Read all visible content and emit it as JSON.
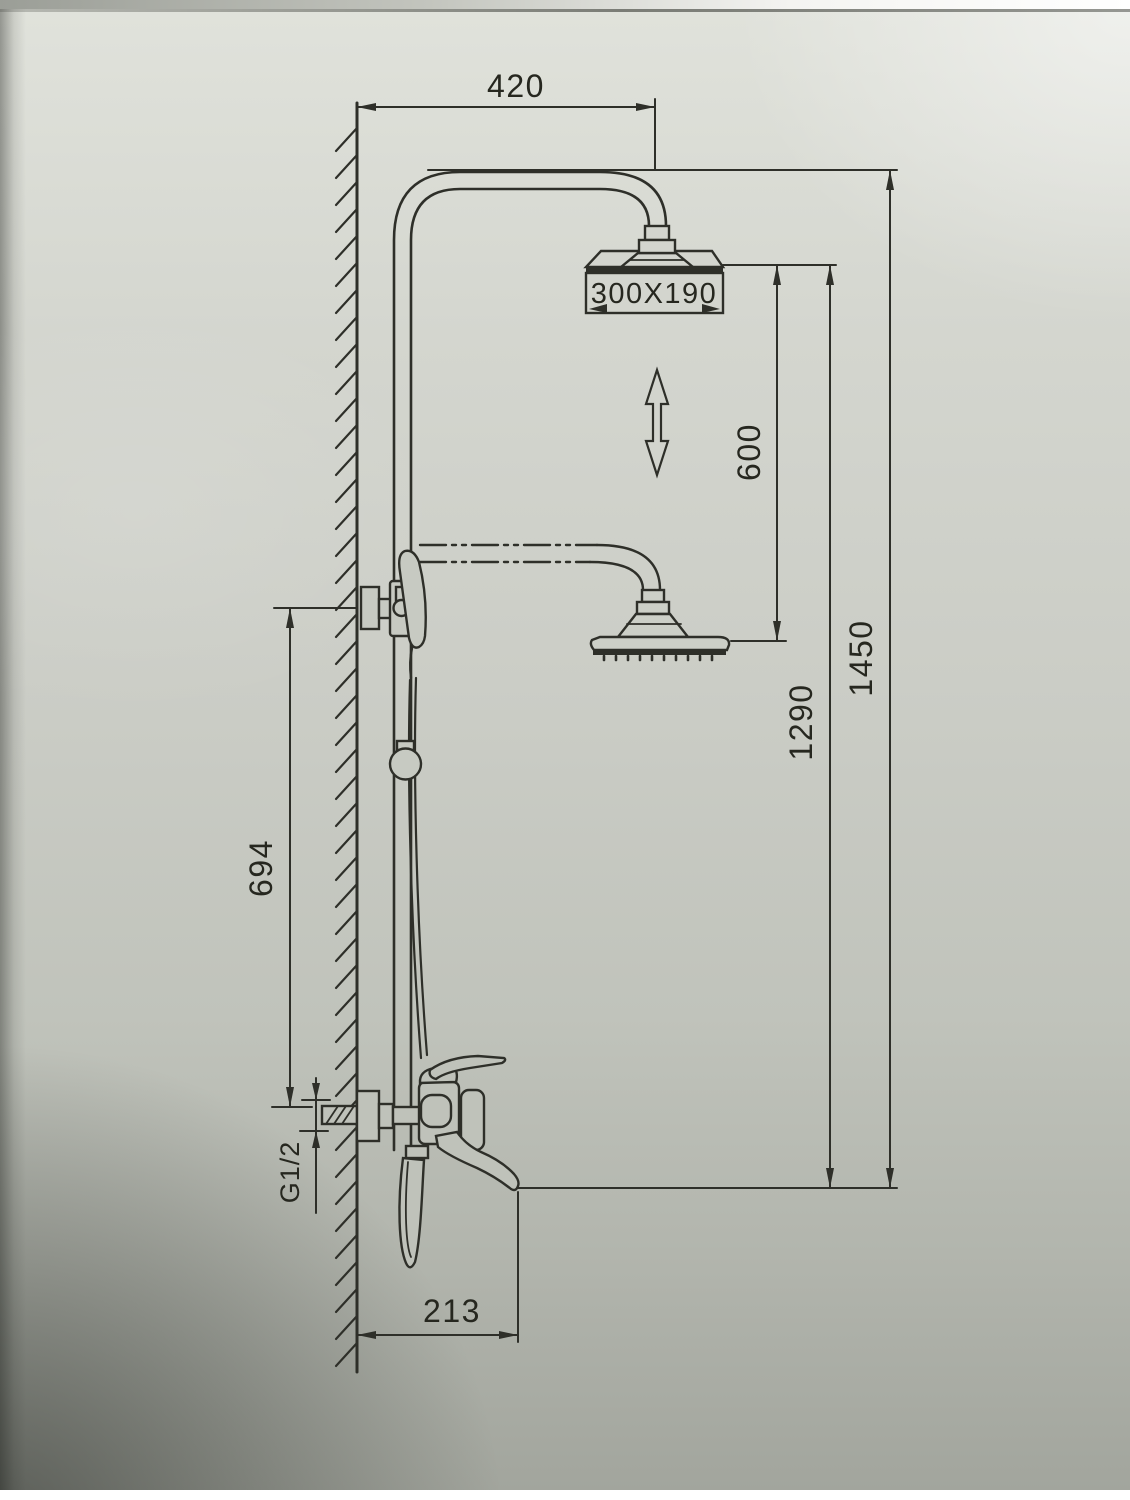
{
  "diagram": {
    "type": "technical-drawing",
    "subject": "wall-mounted shower column with adjustable overhead rain shower, hand shower and bath spout mixer",
    "line_color": "#2e2f29",
    "paper_color": "#cbcec6",
    "dimensions": {
      "top_offset": {
        "label": "420",
        "orientation": "horizontal",
        "meaning": "wall to shower-head drop distance"
      },
      "head_size": {
        "label": "300X190",
        "orientation": "horizontal",
        "meaning": "overhead shower size"
      },
      "height_adjust": {
        "label": "600",
        "orientation": "vertical",
        "meaning": "head height adjustment range"
      },
      "spout_height": {
        "label": "1290",
        "orientation": "vertical",
        "meaning": "spout level to head top"
      },
      "overall_height": {
        "label": "1450",
        "orientation": "vertical",
        "meaning": "spout level to pipe top"
      },
      "bracket_span": {
        "label": "694",
        "orientation": "vertical",
        "meaning": "holder bracket to inlet centre"
      },
      "inlet_thread": {
        "label": "G1/2",
        "orientation": "vertical",
        "meaning": "inlet connection thread"
      },
      "spout_reach": {
        "label": "213",
        "orientation": "horizontal",
        "meaning": "wall to spout tip"
      }
    },
    "symbols": {
      "double_arrow": "up-down adjustability indicator",
      "wall_hatch": "mounting wall section",
      "phantom_lines": "lowered position of shower arm"
    }
  }
}
